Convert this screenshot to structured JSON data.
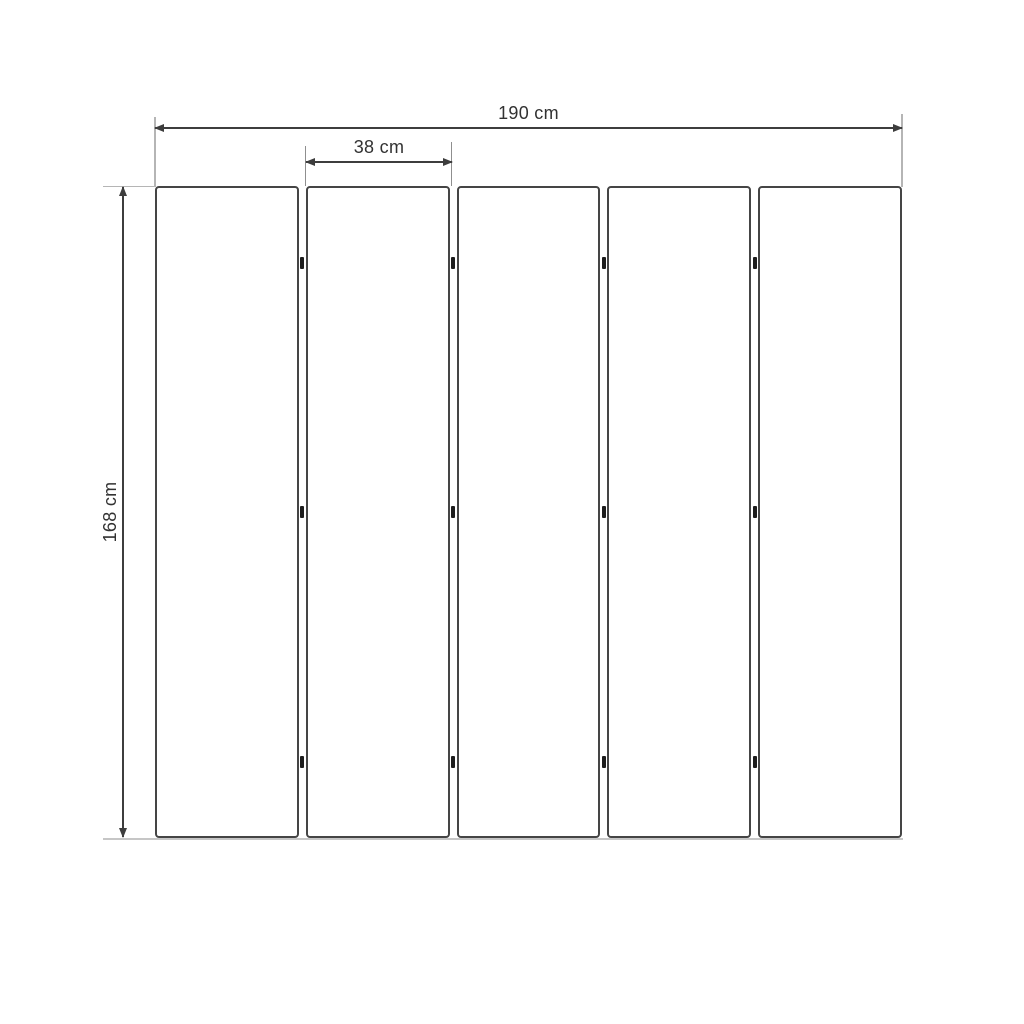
{
  "diagram": {
    "labels": {
      "total_width": "190 cm",
      "panel_width": "38 cm",
      "height": "168 cm"
    },
    "panels": {
      "count": 5,
      "hinge_rows": [
        0.118,
        0.5,
        0.883
      ]
    },
    "colors": {
      "dimension_line": "#3d3d3d",
      "extension_line": "#b5b5b5",
      "panel_border": "#454545",
      "hinge": "#1d1d1d",
      "text": "#323232",
      "background": "#ffffff"
    }
  }
}
